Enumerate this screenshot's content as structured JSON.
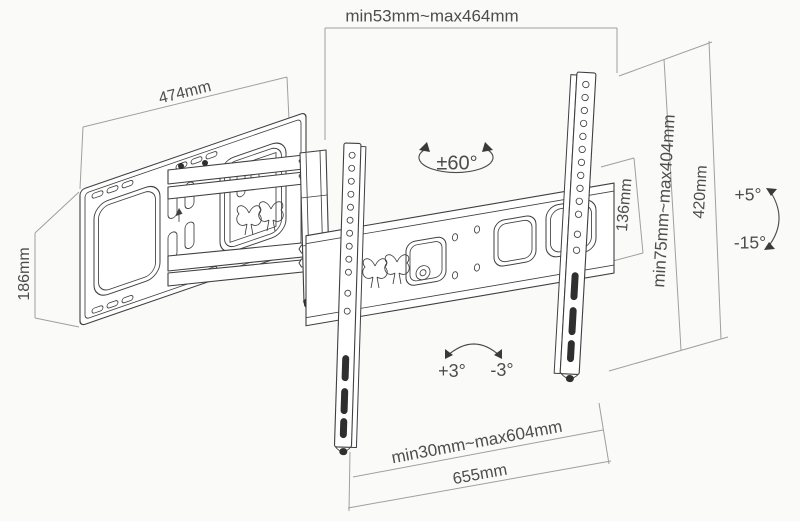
{
  "diagram": {
    "type": "tv-wall-mount-dimension-drawing",
    "labels": {
      "top_width_range": "min53mm~max464mm",
      "wall_plate_width": "474mm",
      "wall_plate_height": "186mm",
      "swivel_range": "±60°",
      "hole_spacing": "136mm",
      "vertical_range": "min75mm~max404mm",
      "bracket_height": "420mm",
      "tilt_up": "+5°",
      "tilt_down": "-15°",
      "roll_left": "+3°",
      "roll_right": "-3°",
      "bottom_width_range": "min30mm~max604mm",
      "total_width": "655mm"
    },
    "colors": {
      "background": "#fafaf9",
      "drawing_line": "#3f3f3f",
      "dimension_line": "#9f9f9f",
      "label_text": "#4d4d4d"
    }
  }
}
